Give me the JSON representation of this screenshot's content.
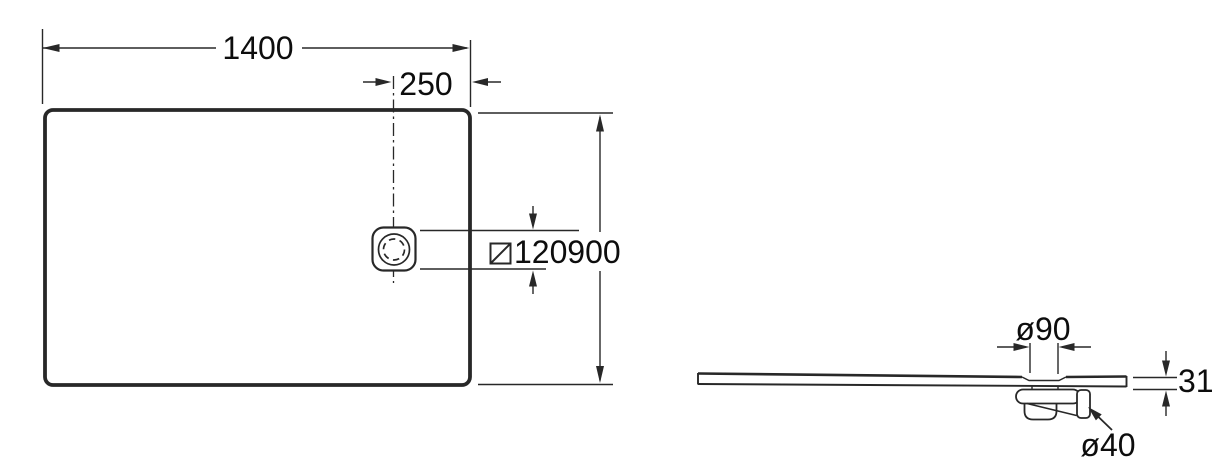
{
  "diagram": {
    "subject": "rectangular shower tray technical drawing (plan view and side profile)",
    "colors": {
      "line": "#282828",
      "text": "#0d0d0d",
      "background": "#ffffff"
    }
  },
  "top_view": {
    "name": "plan view",
    "width": "1400",
    "depth": "900",
    "drain_offset_from_right_edge": "250",
    "drain_square": "120"
  },
  "side_view": {
    "name": "side profile view",
    "drain_cover_diameter": "ø90",
    "tray_thickness": "31",
    "waste_outlet_diameter": "ø40"
  }
}
